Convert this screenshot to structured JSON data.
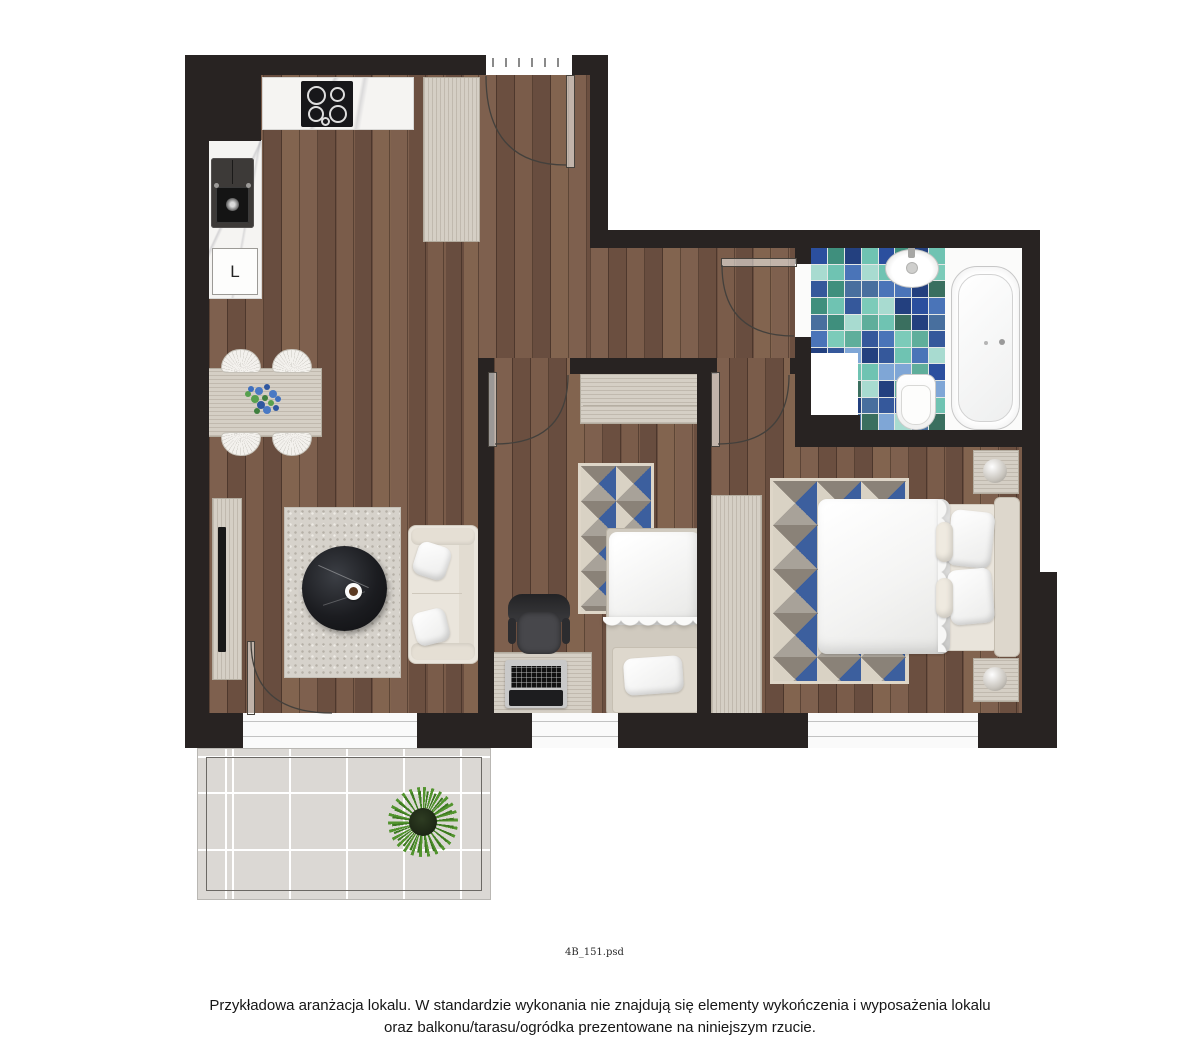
{
  "caption": {
    "line1": "Przykładowa aranżacja lokalu. W standardzie wykonania nie znajdują się elementy wykończenia i wyposażenia lokalu",
    "line2": "oraz balkonu/tarasu/ogródka prezentowane na niniejszym rzucie."
  },
  "file_label": "4B_151.psd",
  "kitchen": {
    "fridge_label": "L"
  },
  "palette": {
    "wall": "#282322",
    "wood_base": "#76594a",
    "light_wood": "#d5cfc5",
    "marble": "#f5f4f2",
    "sofa_cream": "#eae5dc",
    "rug_blue": "#3c5f9e",
    "living_rug": "#d6d2cb",
    "balcony_tile": "#dbd8d4",
    "plant_green": "#52942e",
    "arc_line": "#43403c"
  },
  "bathroom": {
    "mosaic_palette": [
      "#2b4f9e",
      "#4a74b8",
      "#7fa6d6",
      "#3f8f7d",
      "#7ccbb9",
      "#a8dbd0",
      "#23407f",
      "#5fae9b",
      "#486f9e",
      "#6fc3b2",
      "#35589b",
      "#3a6f5f"
    ]
  }
}
